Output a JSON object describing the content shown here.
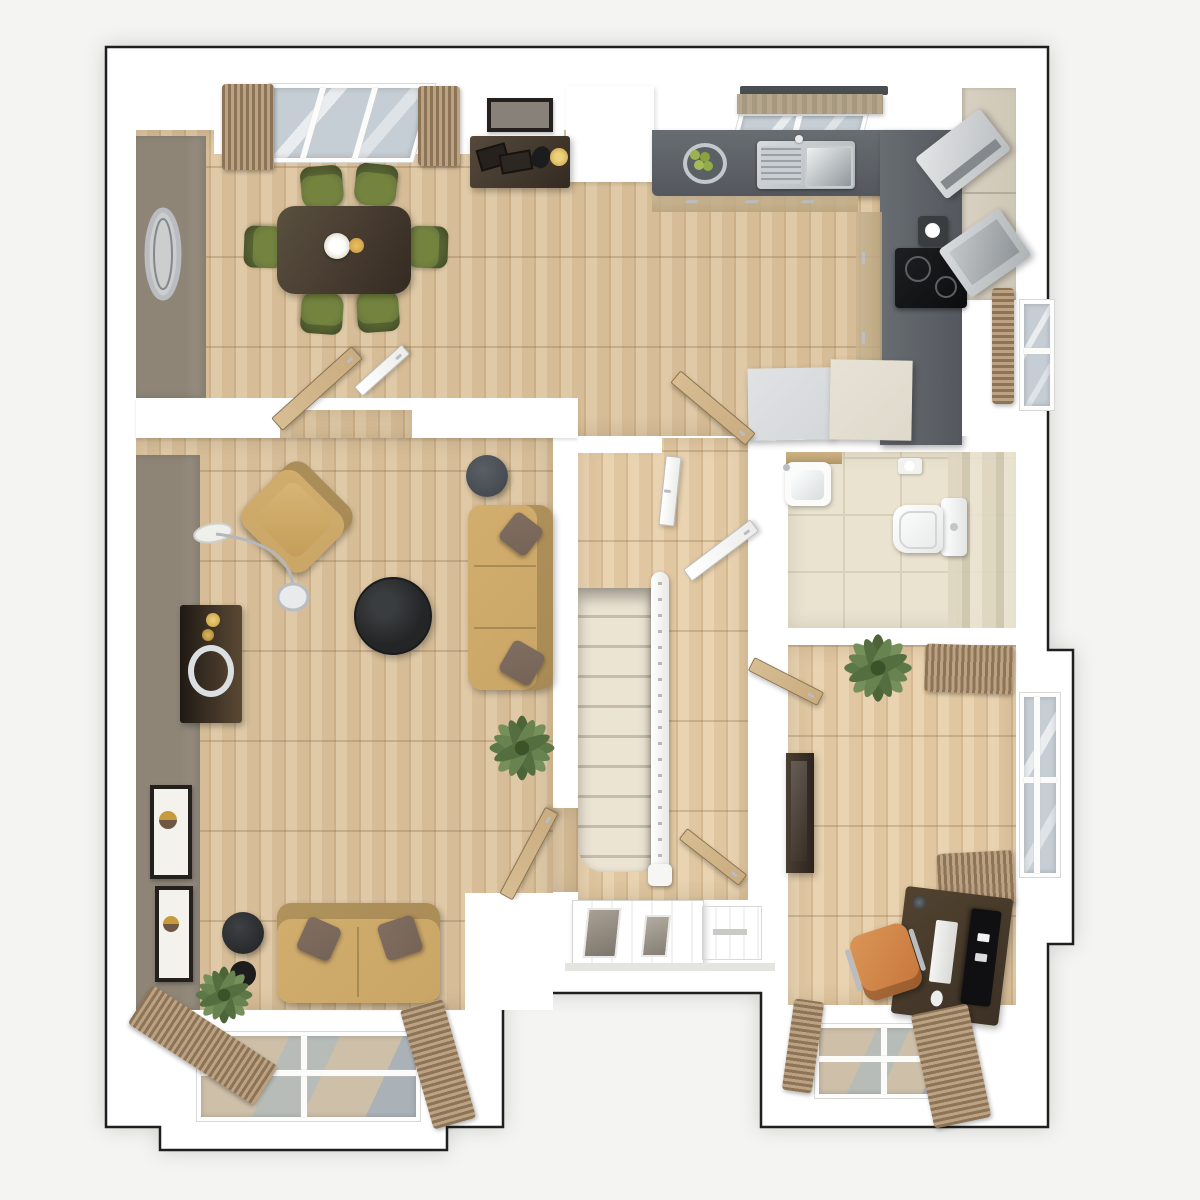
{
  "meta": {
    "view": "top-down 3d dollhouse floor plan render",
    "floor": "ground-floor",
    "visible_text": "none"
  },
  "palette": {
    "bg": "#f4f4f2",
    "wall": "#ffffff",
    "outline": "#1f1f1f",
    "wood-a": "#dfc9a7",
    "wood-b": "#d6bd97",
    "wood-c": "#cbb089",
    "taupe": "#8e8577",
    "taupe2": "#9a9183",
    "counter-a": "#686d72",
    "counter-b": "#54585e",
    "cab-cream": "#cfc7b6",
    "cab-face": "#c8b491",
    "sofa": "#c9a566",
    "sofa-dark": "#ad8a4c",
    "cushion": "#756357",
    "olive": "#68773d",
    "olive-dark": "#4f5c2d",
    "walnut": "#473b30",
    "walnut2": "#332a22",
    "marble": "#232526",
    "tile": "#eae3d0",
    "tile-line": "#d8d0ba",
    "stripe-a": "#ded6c1",
    "stripe-b": "#cec5ad",
    "carpet": "#ece4d3",
    "curtain-a": "#8c7457",
    "curtain-b": "#bda183",
    "glass-a": "#c5ced4",
    "glass-b": "#e9edef",
    "door-wood": "#c9ac80",
    "orange": "#c8763a",
    "plant": "#5d7847",
    "desk": "#3c3126",
    "chrome": "#b9bdc1",
    "gold": "#c79a3d",
    "white-goods": "#d4d7d9",
    "cream-goods": "#ded9cb"
  },
  "rooms": [
    {
      "id": "dining",
      "name": "dining-area"
    },
    {
      "id": "kitchen",
      "name": "kitchen"
    },
    {
      "id": "living",
      "name": "living-room"
    },
    {
      "id": "hall",
      "name": "hallway-with-stairs"
    },
    {
      "id": "wc",
      "name": "cloakroom-wc"
    },
    {
      "id": "study",
      "name": "study"
    }
  ],
  "furniture": {
    "dining": [
      "dining-table",
      "dining-chair x6",
      "table-centerpiece",
      "console-table",
      "framed-picture",
      "round-wall-mirror",
      "window-curtains"
    ],
    "kitchen": [
      "l-shaped-worktop",
      "double-sink-with-drainer",
      "fruit-bowl",
      "roller-blind",
      "hob",
      "coffee-machine",
      "microwave",
      "tall-cabinets",
      "open-appliance",
      "island-units",
      "side-window-blind"
    ],
    "living": [
      "armchair",
      "arc-floor-lamp",
      "media-sideboard",
      "round-marble-coffee-table",
      "three-seat-sofa",
      "two-seat-sofa",
      "side-table x2",
      "potted-plant x2",
      "framed-print x2",
      "bay-window"
    ],
    "hall": [
      "carpeted-staircase",
      "banister",
      "front-door-with-glazing",
      "interior-door x5"
    ],
    "wc": [
      "toilet",
      "basin-on-shelf",
      "toilet-roll-holder",
      "tiled-feature-wall"
    ],
    "study": [
      "desk",
      "monitor",
      "keyboard",
      "mouse",
      "desk-lamp",
      "office-chair",
      "tall-cabinet",
      "potted-plant",
      "window x2",
      "window-curtains"
    ]
  },
  "windows": {
    "dining-top": 1,
    "kitchen-top": 1,
    "kitchen-right": 1,
    "living-bay-bottom": 1,
    "study-right": 1,
    "study-bottom": 1
  }
}
